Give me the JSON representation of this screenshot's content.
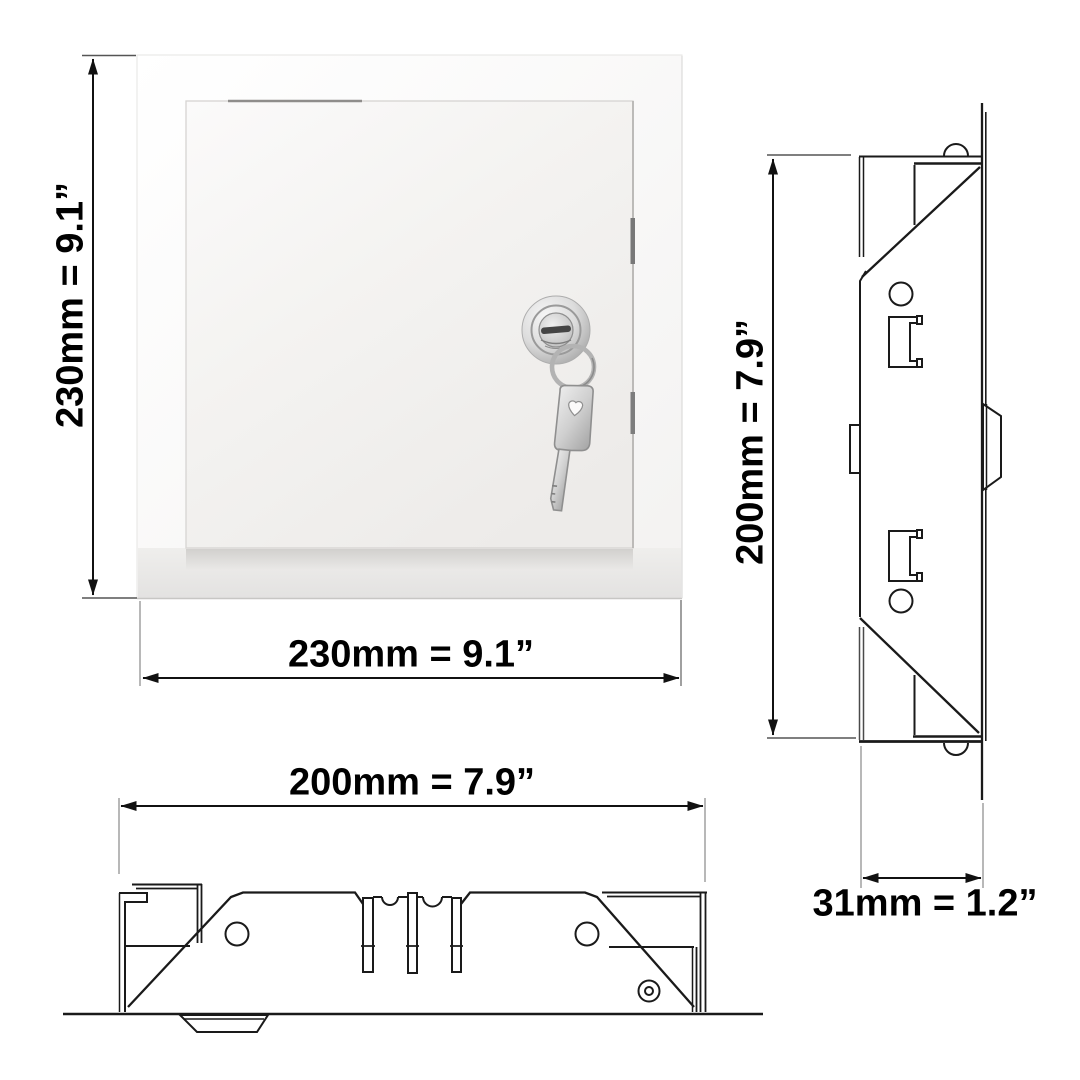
{
  "page": {
    "background": "#ffffff"
  },
  "drawing": {
    "product": "lockable-access-panel-with-key",
    "views": {
      "front": {
        "height_label": "230mm = 9.1”",
        "width_label": "230mm = 9.1”"
      },
      "bottom": {
        "width_label": "200mm = 7.9”"
      },
      "side": {
        "height_label": "200mm = 7.9”",
        "depth_label": "31mm = 1.2”"
      }
    },
    "colors": {
      "line": "#1a1a1a",
      "extension_line": "#909090",
      "label_text": "#000000",
      "panel_white": "#f7f6f5",
      "metal_light": "#f2f2f2",
      "metal_dark": "#a9a9a9"
    }
  }
}
